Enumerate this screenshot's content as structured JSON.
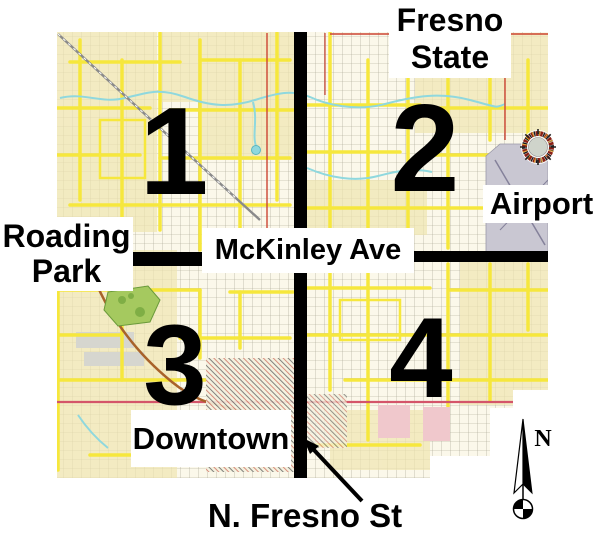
{
  "map": {
    "region_labels": {
      "fresno_state": {
        "line1": "Fresno",
        "line2": "State"
      },
      "airport": "Airport",
      "roading_park": {
        "line1": "Roading",
        "line2": "Park"
      },
      "downtown": "Downtown"
    },
    "street_labels": {
      "mckinley_ave": "McKinley Ave",
      "n_fresno_st": "N. Fresno St"
    },
    "quadrants": {
      "q1": "1",
      "q2": "2",
      "q3": "3",
      "q4": "4"
    },
    "compass": {
      "north_label": "N"
    },
    "colors": {
      "map_base": "#fbf8ea",
      "block_tint": "#efe6b0",
      "street_highlight": "#f6e73c",
      "water": "#8fd8de",
      "park_green": "#a5c95f",
      "airport_gray": "#c9c7d2",
      "pink_zone": "#f0c8cc",
      "accent_red": "#cc4433",
      "overlay_black": "#000000"
    }
  }
}
